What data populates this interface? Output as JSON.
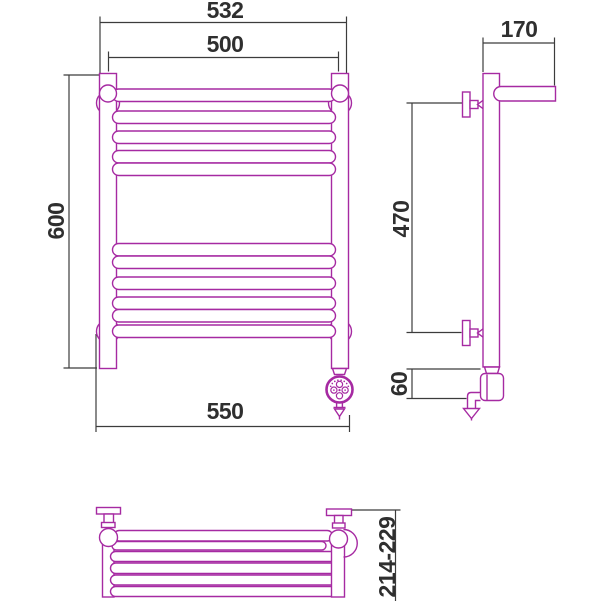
{
  "drawing": {
    "type": "technical-dimension-drawing",
    "subject": "ladder towel radiator: front view, side view and top view",
    "body_color": "#a62aa2",
    "dimension_line_color": "#3c3c3c",
    "text_color": "#2f2f2f",
    "background_color": "#ffffff"
  },
  "dimensions": {
    "front_width_outer": "532",
    "front_width_centers": "500",
    "front_height": "600",
    "front_width_bottom": "550",
    "side_depth_top": "170",
    "side_bracket_spacing": "470",
    "side_bottom_offset": "60",
    "top_view_depth_range": "214-229"
  }
}
